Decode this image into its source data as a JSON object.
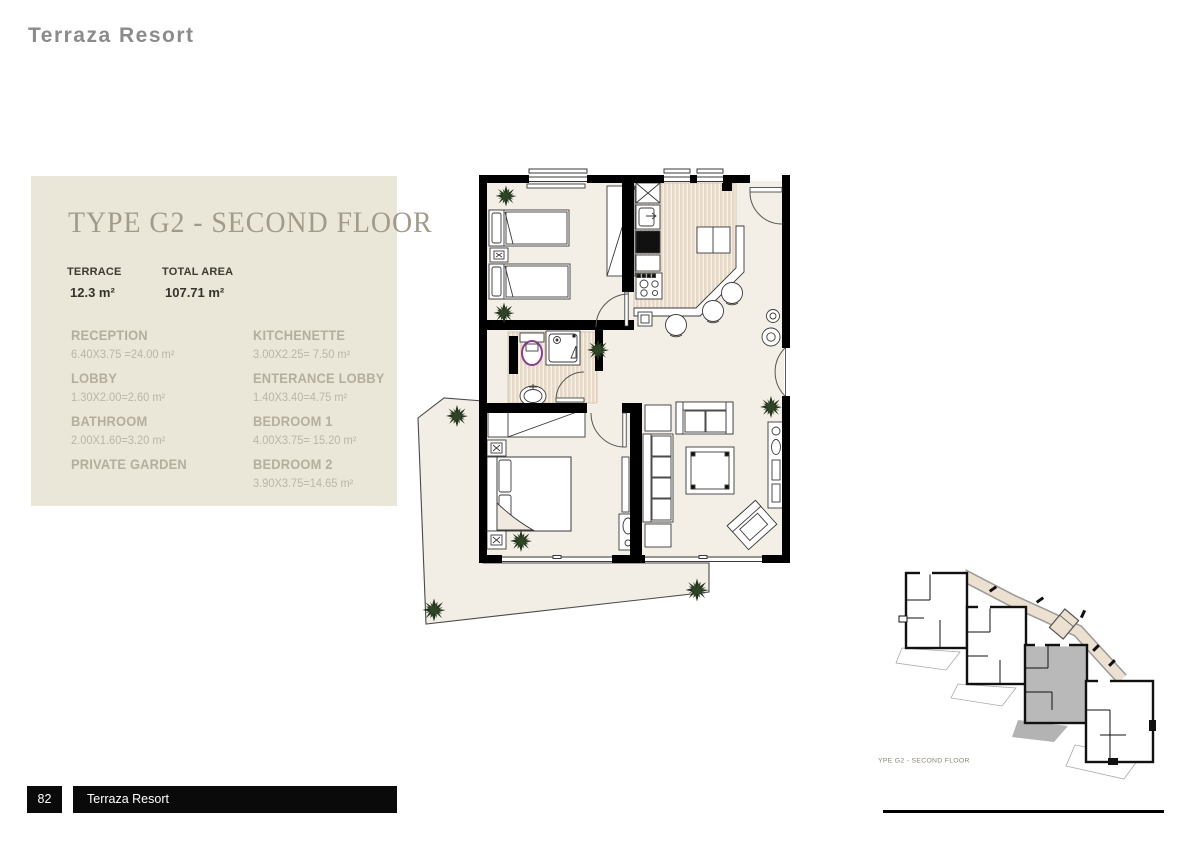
{
  "page": {
    "header_title": "Terraza Resort",
    "page_number": "82",
    "footer_title": "Terraza Resort"
  },
  "panel": {
    "title": "TYPE G2 - SECOND FLOOR",
    "stats": [
      {
        "label": "TERRACE",
        "value": "12.3 m²"
      },
      {
        "label": "TOTAL AREA",
        "value": "107.71 m²"
      }
    ],
    "rooms_left": [
      {
        "name": "RECEPTION",
        "dims": "6.40X3.75 =24.00 m²"
      },
      {
        "name": "LOBBY",
        "dims": "1.30X2.00=2.60 m²"
      },
      {
        "name": "BATHROOM",
        "dims": "2.00X1.60=3.20 m²"
      },
      {
        "name": "PRIVATE GARDEN"
      }
    ],
    "rooms_right": [
      {
        "name": "KITCHENETTE",
        "dims": "3.00X2.25= 7.50 m²"
      },
      {
        "name": "ENTERANCE LOBBY",
        "dims": "1.40X3.40=4.75 m²"
      },
      {
        "name": "BEDROOM 1",
        "dims": "4.00X3.75= 15.20 m²"
      },
      {
        "name": "BEDROOM 2",
        "dims": "3.90X3.75=14.65 m²"
      }
    ]
  },
  "floor_plan": {
    "wall_color": "#000000",
    "floor_color": "#f4efe6",
    "stripe_color": "#e7d9c6",
    "terrace_color": "#f3eee5",
    "palm_color": "#24351f",
    "toilet_accent": "#8b3c8e"
  },
  "site_plan": {
    "caption": "YPE G2 - SECOND FLOOR",
    "highlight_color": "#b9b9b9",
    "corridor_color": "#ece0d0"
  }
}
